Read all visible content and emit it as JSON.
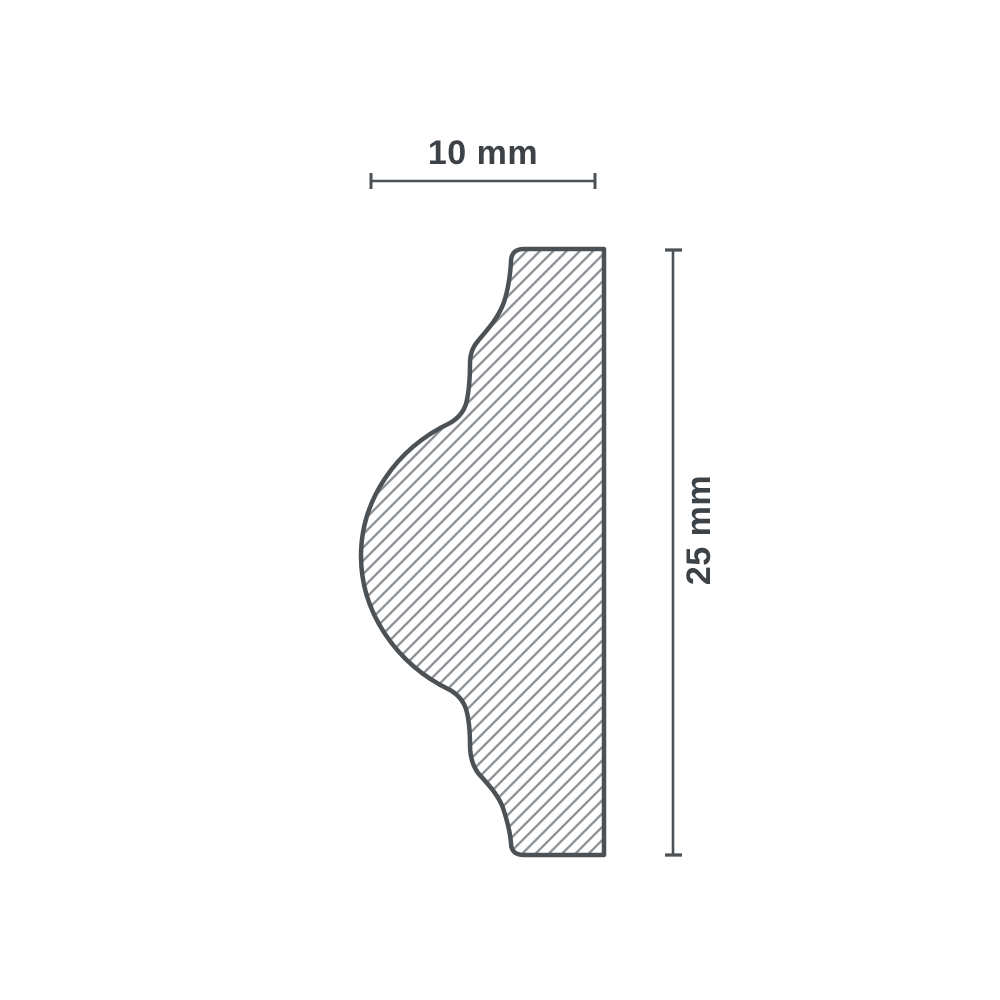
{
  "diagram": {
    "type": "molding-profile-cross-section",
    "dimensions": {
      "width": {
        "label": "10 mm"
      },
      "height": {
        "label": "25 mm"
      }
    }
  },
  "colors": {
    "background": "#ffffff",
    "outline": "#4c5156",
    "hatch": "#8b9095",
    "dimension_line": "#4c5156",
    "label_text": "#3d4247"
  }
}
